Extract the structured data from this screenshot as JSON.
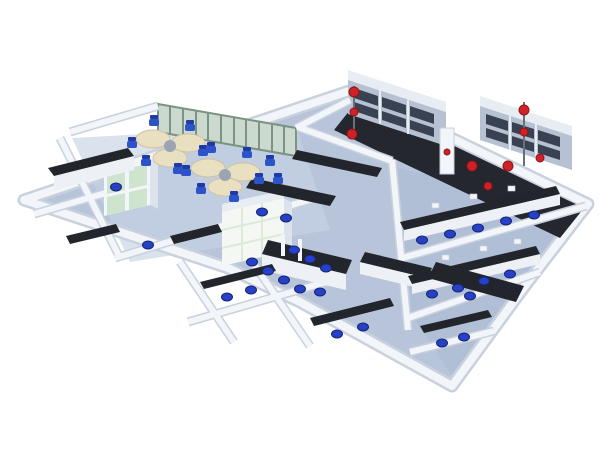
{
  "meta": {
    "description": "isometric 3D rendering of a laboratory interior layout plan",
    "width_px": 600,
    "height_px": 450
  },
  "scene": {
    "type": "isometric-lab-floorplan",
    "zones": [
      "office-workstation-area",
      "glass-partition-wall",
      "central-wet-lab-benches",
      "instrument-rooms-right",
      "tall-storage-cabinet-walls",
      "bottom-lab-rooms",
      "emergency-equipment-stations"
    ],
    "equipment": {
      "desk_clusters": 2,
      "office_chairs": 14,
      "lab_stools": 28,
      "tall_cabinet_rows": 2,
      "emergency_red_stations": 2,
      "fume_cabinet_blocks": 1
    }
  },
  "palette": {
    "background": "#ffffff",
    "floor": "#b7c4da",
    "floor_light": "#c6d2e4",
    "floor_dim": "#a9b9d1",
    "floor_dark_band": "#24272d",
    "wall_face": "#f2f5f9",
    "wall_side": "#dde3ea",
    "wall_shadow": "#c9d1dd",
    "bench_top_dark": "#22252b",
    "bench_base": "#edf0f5",
    "stool_blue": "#2740c8",
    "stool_rim": "#16246e",
    "chair_blue": "#2d53c8",
    "chair_back": "#1d3aa6",
    "desk_cream": "#e9dfc1",
    "desk_edge": "#cfc3a0",
    "desk_hub": "#9aa4b2",
    "partition_frame": "#7a9383",
    "partition_pane": "#ccd9cf",
    "cabinet_face": "#b6c2d2",
    "cabinet_frame": "#e8edf4",
    "cabinet_opening": "#394152",
    "green_door": "#cfe4cf",
    "fume_face": "#f4f7f3",
    "fume_grid": "#dcead8",
    "red_equipment": "#cf2128",
    "red_dark": "#8f1418",
    "pole_gray": "#6a7077"
  }
}
